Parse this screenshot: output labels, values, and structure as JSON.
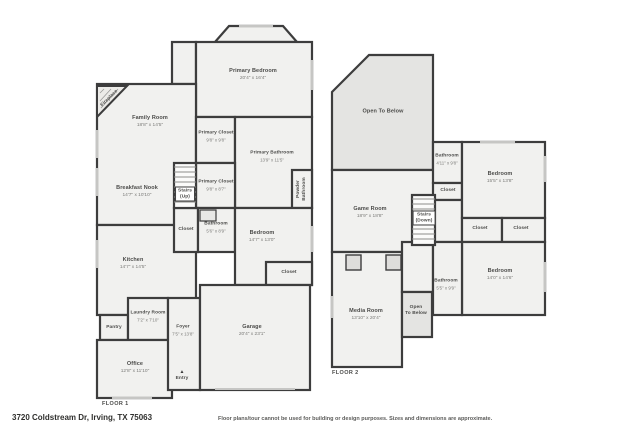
{
  "footer": {
    "address": "3720 Coldstream Dr, Irving, TX 75063",
    "disclaimer": "Floor plans/tour cannot be used for building or design purposes. Sizes and dimensions are approximate."
  },
  "colors": {
    "walls": "#3d3d3d",
    "room_fill": "#f1f1ef",
    "open_to_below_fill": "#e4e4e2",
    "window": "#c6c6c4",
    "background": "#ffffff"
  },
  "floors": [
    {
      "label": "FLOOR 1",
      "rooms": [
        {
          "name": "Primary Bedroom",
          "dims": "20'4\" x 16'4\"",
          "x": 253,
          "y": 75
        },
        {
          "name": "Family Room",
          "dims": "18'8\" x 14'5\"",
          "x": 150,
          "y": 122
        },
        {
          "name": "Fireplace",
          "x": 110,
          "y": 99,
          "rotate": -45,
          "small": true
        },
        {
          "name": "Primary Closet",
          "dims": "9'8\" x 9'8\"",
          "x": 216,
          "y": 137,
          "small": true
        },
        {
          "name": "Primary Bathroom",
          "dims": "13'9\" x 11'5\"",
          "x": 272,
          "y": 157,
          "small": true
        },
        {
          "name": "Primary Closet",
          "dims": "9'8\" x 8'7\"",
          "x": 216,
          "y": 186,
          "small": true
        },
        {
          "name": "Powder\nBathroom",
          "x": 302,
          "y": 189,
          "rotate": -90,
          "small": true
        },
        {
          "name": "Breakfast Nook",
          "dims": "14'7\" x 10'10\"",
          "x": 137,
          "y": 192
        },
        {
          "name": "Stairs\n(Up)",
          "x": 185,
          "y": 194,
          "boxed": true,
          "small": true
        },
        {
          "name": "Closet",
          "x": 186,
          "y": 230,
          "small": true
        },
        {
          "name": "Bathroom",
          "dims": "5'6\" x 8'9\"",
          "x": 216,
          "y": 228,
          "small": true
        },
        {
          "name": "Bedroom",
          "dims": "14'7\" x 13'0\"",
          "x": 262,
          "y": 237
        },
        {
          "name": "Closet",
          "x": 289,
          "y": 273,
          "small": true
        },
        {
          "name": "Kitchen",
          "dims": "14'7\" x 14'5\"",
          "x": 133,
          "y": 264
        },
        {
          "name": "Laundry Room",
          "dims": "7'2\" x 7'10\"",
          "x": 148,
          "y": 317,
          "small": true
        },
        {
          "name": "Pantry",
          "x": 114,
          "y": 328,
          "small": true
        },
        {
          "name": "Foyer",
          "dims": "7'5\" x 13'8\"",
          "x": 183,
          "y": 331,
          "small": true
        },
        {
          "name": "Office",
          "dims": "12'8\" x 11'10\"",
          "x": 135,
          "y": 368
        },
        {
          "name": "Entry",
          "x": 182,
          "y": 376,
          "marker": "▲",
          "small": true
        },
        {
          "name": "Garage",
          "dims": "20'4\" x 23'1\"",
          "x": 252,
          "y": 331
        }
      ]
    },
    {
      "label": "FLOOR 2",
      "rooms": [
        {
          "name": "Open To Below",
          "x": 383,
          "y": 112
        },
        {
          "name": "Game Room",
          "dims": "18'9\" x 18'8\"",
          "x": 370,
          "y": 213
        },
        {
          "name": "Stairs\n(Down)",
          "x": 424,
          "y": 218,
          "boxed": true,
          "small": true
        },
        {
          "name": "Closet",
          "x": 448,
          "y": 191,
          "small": true
        },
        {
          "name": "Bathroom",
          "dims": "4'11\" x 9'8\"",
          "x": 447,
          "y": 160,
          "small": true
        },
        {
          "name": "Bedroom",
          "dims": "15'5\" x 13'8\"",
          "x": 500,
          "y": 178
        },
        {
          "name": "Closet",
          "x": 480,
          "y": 229,
          "small": true
        },
        {
          "name": "Closet",
          "x": 521,
          "y": 229,
          "small": true
        },
        {
          "name": "Bedroom",
          "dims": "14'0\" x 14'6\"",
          "x": 500,
          "y": 275
        },
        {
          "name": "Bathroom",
          "dims": "5'5\" x 9'9\"",
          "x": 446,
          "y": 285,
          "small": true
        },
        {
          "name": "Open\nTo Below",
          "x": 416,
          "y": 311,
          "small": true
        },
        {
          "name": "Media Room",
          "dims": "13'10\" x 20'4\"",
          "x": 366,
          "y": 315
        }
      ]
    }
  ]
}
